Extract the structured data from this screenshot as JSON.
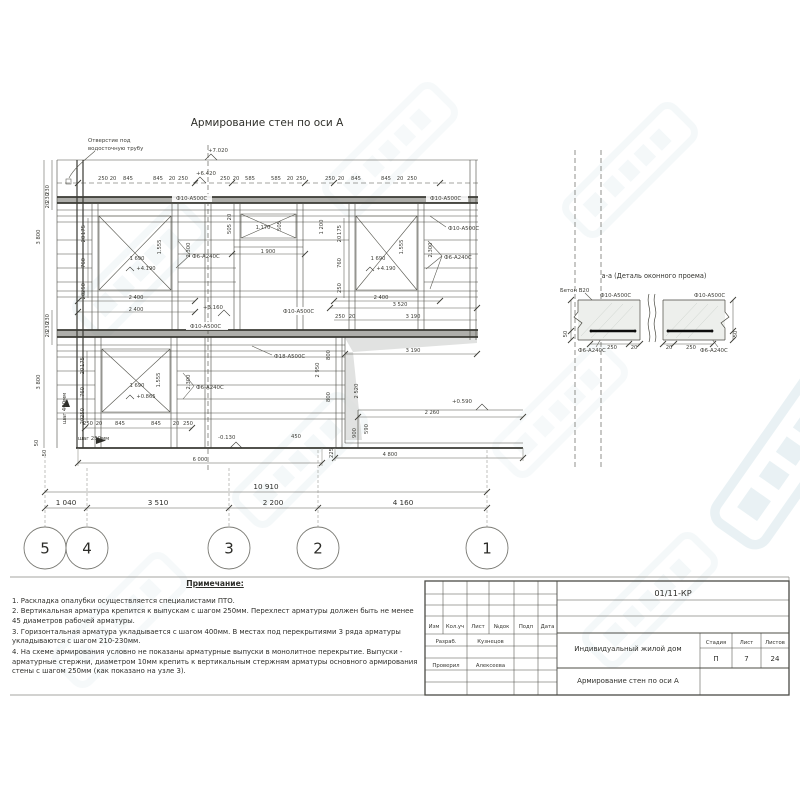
{
  "page": {
    "drawing_title": "Армирование стен по оси А",
    "detail_title": "а-а (Деталь оконного проема)"
  },
  "colors": {
    "line": "#4a4a42",
    "watermark": "#6fa7b8"
  },
  "drawing": {
    "labels": [
      {
        "t": "250",
        "x": 103,
        "y": 180
      },
      {
        "t": "20",
        "x": 113,
        "y": 180
      },
      {
        "t": "845",
        "x": 128,
        "y": 180
      },
      {
        "t": "845",
        "x": 158,
        "y": 180
      },
      {
        "t": "20",
        "x": 172,
        "y": 180
      },
      {
        "t": "250",
        "x": 183,
        "y": 180
      },
      {
        "t": "250",
        "x": 225,
        "y": 180
      },
      {
        "t": "20",
        "x": 236,
        "y": 180
      },
      {
        "t": "585",
        "x": 250,
        "y": 180
      },
      {
        "t": "585",
        "x": 276,
        "y": 180
      },
      {
        "t": "20",
        "x": 290,
        "y": 180
      },
      {
        "t": "250",
        "x": 301,
        "y": 180
      },
      {
        "t": "250",
        "x": 330,
        "y": 180
      },
      {
        "t": "20",
        "x": 341,
        "y": 180
      },
      {
        "t": "845",
        "x": 356,
        "y": 180
      },
      {
        "t": "845",
        "x": 386,
        "y": 180
      },
      {
        "t": "20",
        "x": 400,
        "y": 180
      },
      {
        "t": "250",
        "x": 412,
        "y": 180
      },
      {
        "t": "+7.020",
        "x": 208,
        "y": 152,
        "c": "el"
      },
      {
        "t": "+6.420",
        "x": 196,
        "y": 175,
        "c": "el"
      },
      {
        "t": "+4.190",
        "x": 146,
        "y": 270
      },
      {
        "t": "+4.190",
        "x": 386,
        "y": 270
      },
      {
        "t": "+3.160",
        "x": 203,
        "y": 309,
        "c": "el"
      },
      {
        "t": "+0.865",
        "x": 146,
        "y": 398
      },
      {
        "t": "+0.590",
        "x": 452,
        "y": 403,
        "c": "el"
      },
      {
        "t": "-0.130",
        "x": 218,
        "y": 439,
        "c": "el"
      },
      {
        "t": "1 690",
        "x": 137,
        "y": 260
      },
      {
        "t": "1.555",
        "x": 161,
        "y": 247,
        "r": -90
      },
      {
        "t": "2.300",
        "x": 190,
        "y": 250,
        "r": -90
      },
      {
        "t": "2 400",
        "x": 136,
        "y": 299
      },
      {
        "t": "2 400",
        "x": 136,
        "y": 311
      },
      {
        "t": "175",
        "x": 85,
        "y": 230,
        "r": -90
      },
      {
        "t": "20",
        "x": 85,
        "y": 239,
        "r": -90
      },
      {
        "t": "760",
        "x": 85,
        "y": 263,
        "r": -90
      },
      {
        "t": "250",
        "x": 85,
        "y": 288,
        "r": -90
      },
      {
        "t": "20",
        "x": 85,
        "y": 296,
        "r": -90
      },
      {
        "t": "1.170",
        "x": 263,
        "y": 229
      },
      {
        "t": "505",
        "x": 281,
        "y": 226,
        "r": -90
      },
      {
        "t": "1 900",
        "x": 268,
        "y": 253
      },
      {
        "t": "1 200",
        "x": 323,
        "y": 227,
        "r": -90
      },
      {
        "t": "20",
        "x": 231,
        "y": 217,
        "r": -90
      },
      {
        "t": "505",
        "x": 231,
        "y": 229,
        "r": -90
      },
      {
        "t": "1 690",
        "x": 378,
        "y": 260
      },
      {
        "t": "1.555",
        "x": 403,
        "y": 247,
        "r": -90
      },
      {
        "t": "2.300",
        "x": 432,
        "y": 250,
        "r": -90
      },
      {
        "t": "2 400",
        "x": 381,
        "y": 299
      },
      {
        "t": "175",
        "x": 341,
        "y": 230,
        "r": -90
      },
      {
        "t": "20",
        "x": 341,
        "y": 239,
        "r": -90
      },
      {
        "t": "760",
        "x": 341,
        "y": 263,
        "r": -90
      },
      {
        "t": "250",
        "x": 341,
        "y": 288,
        "r": -90
      },
      {
        "t": "3 520",
        "x": 400,
        "y": 306
      },
      {
        "t": "250",
        "x": 340,
        "y": 318
      },
      {
        "t": "20",
        "x": 352,
        "y": 318
      },
      {
        "t": "3 190",
        "x": 413,
        "y": 318
      },
      {
        "t": "3 190",
        "x": 413,
        "y": 352
      },
      {
        "t": "2 950",
        "x": 319,
        "y": 370,
        "r": -90
      },
      {
        "t": "800",
        "x": 330,
        "y": 355,
        "r": -90
      },
      {
        "t": "800",
        "x": 330,
        "y": 397,
        "r": -90
      },
      {
        "t": "2 520",
        "x": 358,
        "y": 391,
        "r": -90
      },
      {
        "t": "900",
        "x": 356,
        "y": 433,
        "r": -90
      },
      {
        "t": "590",
        "x": 368,
        "y": 429,
        "r": -90
      },
      {
        "t": "2 260",
        "x": 432,
        "y": 414
      },
      {
        "t": "4 800",
        "x": 390,
        "y": 456
      },
      {
        "t": "450",
        "x": 296,
        "y": 438
      },
      {
        "t": "225",
        "x": 333,
        "y": 453,
        "r": -90
      },
      {
        "t": "1 690",
        "x": 137,
        "y": 387
      },
      {
        "t": "1.555",
        "x": 160,
        "y": 380,
        "r": -90
      },
      {
        "t": "2.300",
        "x": 190,
        "y": 382,
        "r": -90
      },
      {
        "t": "175",
        "x": 84,
        "y": 362,
        "r": -90
      },
      {
        "t": "20",
        "x": 84,
        "y": 371,
        "r": -90
      },
      {
        "t": "760",
        "x": 84,
        "y": 392,
        "r": -90
      },
      {
        "t": "250",
        "x": 84,
        "y": 413,
        "r": -90
      },
      {
        "t": "20",
        "x": 84,
        "y": 421,
        "r": -90
      },
      {
        "t": "250",
        "x": 88,
        "y": 425
      },
      {
        "t": "20",
        "x": 99,
        "y": 425
      },
      {
        "t": "845",
        "x": 120,
        "y": 425
      },
      {
        "t": "845",
        "x": 156,
        "y": 425
      },
      {
        "t": "20",
        "x": 176,
        "y": 425
      },
      {
        "t": "250",
        "x": 188,
        "y": 425
      },
      {
        "t": "6 000",
        "x": 200,
        "y": 461
      },
      {
        "t": "шаг 400мм",
        "x": 66,
        "y": 424,
        "r": -90,
        "c": "co"
      },
      {
        "t": "шаг 250мм",
        "x": 78,
        "y": 440,
        "c": "co"
      },
      {
        "t": "230",
        "x": 49,
        "y": 190,
        "r": -90
      },
      {
        "t": "230",
        "x": 49,
        "y": 198,
        "r": -90
      },
      {
        "t": "20",
        "x": 49,
        "y": 205,
        "r": -90
      },
      {
        "t": "3 800",
        "x": 40,
        "y": 237,
        "r": -90
      },
      {
        "t": "230",
        "x": 49,
        "y": 319,
        "r": -90
      },
      {
        "t": "230",
        "x": 49,
        "y": 327,
        "r": -90
      },
      {
        "t": "20",
        "x": 49,
        "y": 334,
        "r": -90
      },
      {
        "t": "3 800",
        "x": 40,
        "y": 382,
        "r": -90
      },
      {
        "t": "50",
        "x": 38,
        "y": 443,
        "r": -90
      },
      {
        "t": "50",
        "x": 46,
        "y": 453,
        "r": -90
      },
      {
        "t": "Ф10-А500С",
        "x": 176,
        "y": 200,
        "c": "co"
      },
      {
        "t": "Ф10-А500С",
        "x": 430,
        "y": 200,
        "c": "co"
      },
      {
        "t": "Ф10-А500С",
        "x": 448,
        "y": 230,
        "c": "co"
      },
      {
        "t": "Ф6-А240С",
        "x": 444,
        "y": 259,
        "c": "co"
      },
      {
        "t": "Ф6-А240С",
        "x": 192,
        "y": 258,
        "c": "co"
      },
      {
        "t": "Ф10-А500С",
        "x": 283,
        "y": 313,
        "c": "co"
      },
      {
        "t": "Ф10-А500С",
        "x": 190,
        "y": 328,
        "c": "co"
      },
      {
        "t": "Ф18-А500С",
        "x": 274,
        "y": 358,
        "c": "co"
      },
      {
        "t": "Ф6-А240С",
        "x": 196,
        "y": 389,
        "c": "co"
      },
      {
        "t": "Отверстие под",
        "x": 88,
        "y": 142,
        "c": "co"
      },
      {
        "t": "водосточную трубу",
        "x": 88,
        "y": 150,
        "c": "co"
      },
      {
        "t": "Бетон В20",
        "x": 560,
        "y": 292,
        "c": "co"
      },
      {
        "t": "Ф10-А500С",
        "x": 600,
        "y": 297,
        "c": "co"
      },
      {
        "t": "Ф10-А500С",
        "x": 694,
        "y": 297,
        "c": "co"
      },
      {
        "t": "Ф6-А240С",
        "x": 578,
        "y": 352,
        "c": "co"
      },
      {
        "t": "Ф6-А240С",
        "x": 700,
        "y": 352,
        "c": "co"
      },
      {
        "t": "250",
        "x": 612,
        "y": 349
      },
      {
        "t": "20",
        "x": 634,
        "y": 349
      },
      {
        "t": "20",
        "x": 669,
        "y": 349
      },
      {
        "t": "250",
        "x": 691,
        "y": 349
      },
      {
        "t": "50",
        "x": 567,
        "y": 334,
        "r": -90
      },
      {
        "t": "50",
        "x": 737,
        "y": 334,
        "r": -90
      }
    ]
  },
  "axes": {
    "overall": {
      "t": "10 910",
      "x": 266,
      "y": 489
    },
    "segment_y": 505,
    "segments": [
      {
        "t": "1 040",
        "x": 66
      },
      {
        "t": "3 510",
        "x": 158
      },
      {
        "t": "2 200",
        "x": 273
      },
      {
        "t": "4 160",
        "x": 403
      }
    ],
    "bubble_y": 548,
    "bubbles": [
      {
        "n": "5",
        "x": 45
      },
      {
        "n": "4",
        "x": 87
      },
      {
        "n": "3",
        "x": 229
      },
      {
        "n": "2",
        "x": 318
      },
      {
        "n": "1",
        "x": 487
      }
    ]
  },
  "notes": {
    "heading": "Примечание:",
    "items": [
      "1. Раскладка опалубки осуществляется специалистами ПТО.",
      "2. Вертикальная арматура крепится к выпускам с шагом 250мм. Перехлест арматуры должен быть не менее 45 диаметров рабочей арматуры.",
      "3. Горизонтальная арматура укладывается с шагом 400мм. В местах под перекрытиями 3 ряда арматуры укладываются с шагом 210-230мм.",
      "4. На схеме армирования условно не показаны арматурные выпуски в монолитное перекрытие. Выпуски - арматурные стержни, диаметром 10мм крепить к вертикальным стержням арматуры основного армирования стены с шагом 250мм (как показано на узле 3)."
    ]
  },
  "titleblock": {
    "doc_number": "01/11-КР",
    "columns": [
      "Изм",
      "Кол.уч",
      "Лист",
      "№док",
      "Подп",
      "Дата"
    ],
    "signature_rows": [
      {
        "role": "Разраб.",
        "name": "Кузнецов"
      },
      {
        "role": "Проверил",
        "name": "Алексеева"
      }
    ],
    "project_title": "Индивидуальный жилой дом",
    "stage_header": [
      "Стадия",
      "Лист",
      "Листов"
    ],
    "stage": "П",
    "sheet_number": "7",
    "sheet_total": "24",
    "sheet_title": "Армирование стен по оси А"
  }
}
